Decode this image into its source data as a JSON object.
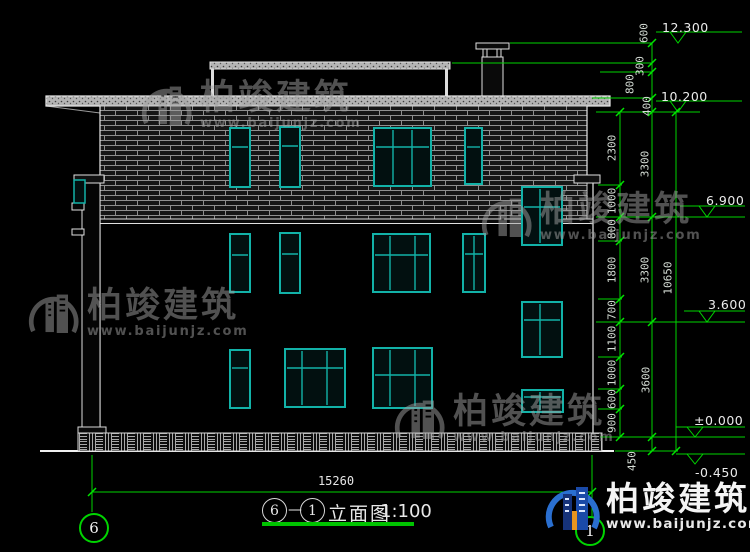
{
  "drawing": {
    "title": {
      "axis_start": "6",
      "separator": "—",
      "axis_end": "1",
      "name": "立面图",
      "scale": "1:100"
    },
    "bottom_axis_bubbles": {
      "left": "6",
      "right": "1"
    },
    "dimensions": {
      "overall_height": "10650",
      "overall_width": "15260",
      "right_top_chain": [
        "600",
        "300",
        "800",
        "400"
      ],
      "right_inner_chain": [
        "2300",
        "1000",
        "800",
        "1800",
        "700",
        "1100",
        "1000",
        "600",
        "900"
      ],
      "right_floor_chain": [
        "3300",
        "3300",
        "3600",
        "450"
      ]
    },
    "elevation_marks": [
      "12.300",
      "10.200",
      "6.900",
      "3.600",
      "±0.000",
      "-0.450"
    ]
  },
  "watermark": {
    "name": "柏竣建筑",
    "url": "www.baijunjz.com"
  },
  "logo": {
    "name": "柏竣建筑",
    "url": "www.baijunjz.com"
  },
  "colors": {
    "dimension_green": "#00d400",
    "window_teal": "#12b2a8",
    "line_white": "#e8e8e8",
    "watermark_gray": "#a2a2a2",
    "logo_blue": "#2a6fd0"
  }
}
